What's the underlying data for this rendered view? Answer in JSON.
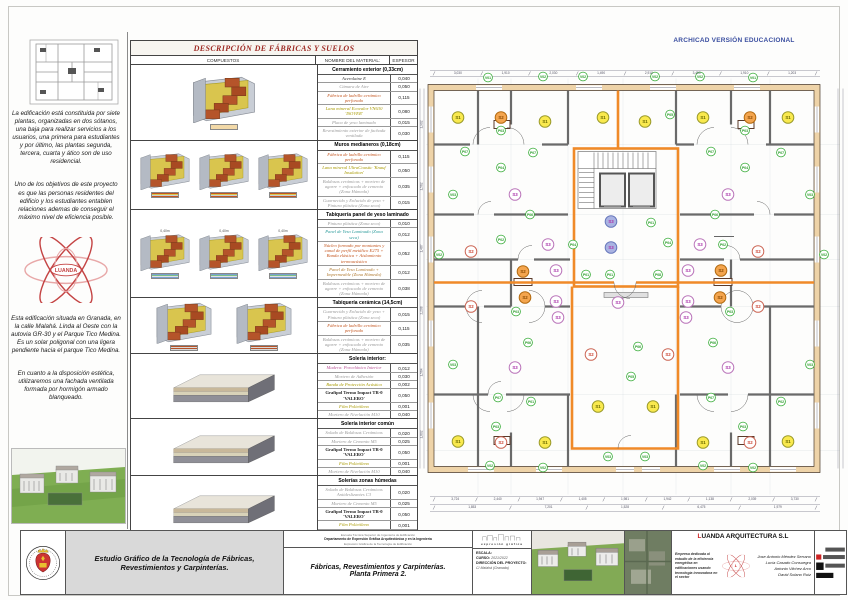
{
  "banner": {
    "archicad": "ARCHICAD VERSIÓN EDUCACIONAL"
  },
  "sidebar": {
    "paragraphs_top": [
      "La edificación está constituida por siete plantas, organizadas en dos sótanos, una baja para realizar servicios a los usuarios, una primera para estudiantes y por último, las plantas segunda, tercera, cuarta y ático son de uso residencial.",
      "Uno de los objetivos de este proyecto es que las personas residentes del edificio y los estudiantes entablen relaciones ademas de conseguir el máximo nivel de eficiencia posible."
    ],
    "paragraphs_bottom": [
      "Esta edificación situada en Granada, en la calle Malahá. Linda al Oeste con la autovia GR-30 y el Parque Tico Medina. Es un solar poligonal con una ligera pendiente hacia el parque Tico Medina.",
      "En cuanto a la disposición estética, utilizaremos una fachada ventilada formada por hormigón armado blanqueado."
    ],
    "luanda_logo_text": "LUANDA"
  },
  "table": {
    "title": "DESCRIPCIÓN DE FÁBRICAS Y SUELOS",
    "columns": {
      "compuestos": "COMPUESTOS",
      "nombre": "NOMBRE DEL MATERIAL:",
      "espesor": "ESPESOR"
    },
    "sections": [
      {
        "header": "Cerramiento exterior (0,33cm)",
        "images": 1,
        "img_type": "wall",
        "leg": "a",
        "rows": [
          {
            "name": "Acerolaine E",
            "v": "0,040",
            "c": "#333333"
          },
          {
            "name": "Cámara de Aire",
            "v": "0,050",
            "c": "#9a9a9a"
          },
          {
            "name": "Fábrica de ladrillo cerámico perforado",
            "v": "0,115",
            "c": "#c4551e"
          },
          {
            "name": "Lana mineral Ecovalor VN630 'ISOVER'",
            "v": "0,080",
            "c": "#a89a00"
          },
          {
            "name": "Placa de yeso laminado",
            "v": "0,015",
            "c": "#9a9a9a"
          },
          {
            "name": "Revestimiento exterior de fachada ventilada",
            "v": "0,030",
            "c": "#9a9a9a"
          }
        ]
      },
      {
        "header": "Muros medianeros (0,18cm)",
        "images": 3,
        "img_type": "wall",
        "leg": "b",
        "rows": [
          {
            "name": "Fábrica de ladrillo cerámico perforado",
            "v": "0,115",
            "c": "#c4551e"
          },
          {
            "name": "Lana mineral UltraCoustic 'Knauf Insulation'",
            "v": "0,050",
            "c": "#a89a00"
          },
          {
            "name": "Baldosas cerámicas + mortero de agarre + enfoscado de cemento (Zona Húmeda)",
            "v": "0,035",
            "c": "#9a9a9a"
          },
          {
            "name": "Guarnecido y Enlucido de yeso + Pintura plástica (Zona seca)",
            "v": "0,015",
            "c": "#9a9a9a"
          }
        ]
      },
      {
        "header": "Tabiquería panel de yeso laminado",
        "images": 3,
        "img_type": "wall",
        "leg": "c",
        "img_note": "0,40m",
        "rows": [
          {
            "name": "Pintura plástica (Zona seca)",
            "v": "0,010",
            "c": "#9a9a9a"
          },
          {
            "name": "Panel de Yeso Laminado (Zona seca)",
            "v": "0,012",
            "c": "#2a9a9a"
          },
          {
            "name": "Núcleo formado por montantes y canal de perfil metálico E275 + Banda elástica + Aislamiento termoacústico",
            "v": "0,052",
            "c": "#c4551e"
          },
          {
            "name": "Panel de Yeso Laminado + Impermeable (Zona Húmeda)",
            "v": "0,012",
            "c": "#b07a30"
          },
          {
            "name": "Baldosas cerámicas + mortero de agarre + enfoscado de cemento (Zona Húmeda)",
            "v": "0,038",
            "c": "#9a9a9a"
          }
        ]
      },
      {
        "header": "Tabiquería cerámica (14,5cm)",
        "images": 2,
        "img_type": "wall",
        "leg": "d",
        "rows": [
          {
            "name": "Guarnecido y Enlucido de yeso + Pintura plástica (Zona seca)",
            "v": "0,015",
            "c": "#9a9a9a"
          },
          {
            "name": "Fábrica de ladrillo cerámico perforado",
            "v": "0,115",
            "c": "#c4551e"
          },
          {
            "name": "Baldosas cerámicas + mortero de agarre + enfoscado de cemento (Zona Húmeda)",
            "v": "0,035",
            "c": "#9a9a9a"
          }
        ]
      },
      {
        "header": "Solería interior:",
        "images": 1,
        "img_type": "floor",
        "leg": "n",
        "rows": [
          {
            "name": "Madera: Porcelánico Interior",
            "v": "0,012",
            "c": "#bb5599"
          },
          {
            "name": "Mortero de Adhesión",
            "v": "0,030",
            "c": "#9a9a9a"
          },
          {
            "name": "Banda de Protección Acústica",
            "v": "0,002",
            "c": "#a89a00"
          },
          {
            "name": "Grafipol Termo Impact TR-0 'VALERO'",
            "v": "0,050",
            "c": "#222222",
            "b": true
          },
          {
            "name": "Film Polietileno",
            "v": "0,001",
            "c": "#a89a00"
          },
          {
            "name": "Mortero de Nivelación M10",
            "v": "0,040",
            "c": "#9a9a9a"
          }
        ]
      },
      {
        "header": "Solería interior común",
        "images": 1,
        "img_type": "floor",
        "leg": "n",
        "rows": [
          {
            "name": "Solado de Baldosas Cerámicas",
            "v": "0,020",
            "c": "#9a9a9a"
          },
          {
            "name": "Mortero de Cemento M5",
            "v": "0,025",
            "c": "#9a9a9a"
          },
          {
            "name": "Grafipol Termo Impact TR-0 'VALERO'",
            "v": "0,050",
            "c": "#222222",
            "b": true
          },
          {
            "name": "Film Polietileno",
            "v": "0,001",
            "c": "#a89a00"
          },
          {
            "name": "Mortero de Nivelación M10",
            "v": "0,040",
            "c": "#9a9a9a"
          }
        ]
      },
      {
        "header": "Solerías zonas húmedas",
        "images": 1,
        "img_type": "floor",
        "leg": "n",
        "rows": [
          {
            "name": "Solado de Baldosas Cerámicas Antideslizantes C3",
            "v": "0,020",
            "c": "#9a9a9a"
          },
          {
            "name": "Mortero de Cemento M5",
            "v": "0,025",
            "c": "#9a9a9a"
          },
          {
            "name": "Grafipol Termo Impact TR-0 'VALERO'",
            "v": "0,050",
            "c": "#222222",
            "b": true
          },
          {
            "name": "Film Polietileno",
            "v": "0,001",
            "c": "#a89a00"
          },
          {
            "name": "Mortero de Nivelación M10",
            "v": "0,040",
            "c": "#9a9a9a"
          }
        ]
      }
    ]
  },
  "plan": {
    "colors": {
      "s1": {
        "fill": "#f9e94e",
        "stroke": "#9a9a2a",
        "text": "#6a6a00"
      },
      "s2o": {
        "fill": "#f4a54e",
        "stroke": "#b26a10",
        "text": "#8a4a00"
      },
      "s2w": {
        "fill": "#ffffff",
        "stroke": "#cc6655",
        "text": "#cc4433"
      },
      "s3w": {
        "fill": "#ffffff",
        "stroke": "#bb77bb",
        "text": "#aa33aa"
      },
      "s3b": {
        "fill": "#aab3e2",
        "stroke": "#6677bb",
        "text": "#aa33aa"
      },
      "v": {
        "fill": "#ffffff",
        "stroke": "#33aa33",
        "text": "#229922"
      },
      "p": {
        "fill": "#ffffff",
        "stroke": "#33aa33",
        "text": "#229922"
      }
    },
    "labels": [
      {
        "t": "S1",
        "k": "s1",
        "x": 40,
        "y": 63
      },
      {
        "t": "S2",
        "k": "s2o",
        "x": 83,
        "y": 63
      },
      {
        "t": "S1",
        "k": "s1",
        "x": 127,
        "y": 67
      },
      {
        "t": "S1",
        "k": "s1",
        "x": 185,
        "y": 63
      },
      {
        "t": "S1",
        "k": "s1",
        "x": 227,
        "y": 67
      },
      {
        "t": "S1",
        "k": "s1",
        "x": 285,
        "y": 63
      },
      {
        "t": "S2",
        "k": "s2o",
        "x": 332,
        "y": 63
      },
      {
        "t": "S1",
        "k": "s1",
        "x": 370,
        "y": 63
      },
      {
        "t": "S3",
        "k": "s3w",
        "x": 97,
        "y": 140
      },
      {
        "t": "S3",
        "k": "s3w",
        "x": 310,
        "y": 140
      },
      {
        "t": "S3",
        "k": "s3b",
        "x": 193,
        "y": 167
      },
      {
        "t": "S3",
        "k": "s3b",
        "x": 193,
        "y": 193
      },
      {
        "t": "S2",
        "k": "s2w",
        "x": 53,
        "y": 197
      },
      {
        "t": "S2",
        "k": "s2w",
        "x": 340,
        "y": 197
      },
      {
        "t": "S3",
        "k": "s3w",
        "x": 130,
        "y": 190
      },
      {
        "t": "S3",
        "k": "s3w",
        "x": 282,
        "y": 190
      },
      {
        "t": "S2",
        "k": "s2o",
        "x": 105,
        "y": 217
      },
      {
        "t": "S3",
        "k": "s3w",
        "x": 138,
        "y": 216
      },
      {
        "t": "S3",
        "k": "s3w",
        "x": 270,
        "y": 216
      },
      {
        "t": "S2",
        "k": "s2o",
        "x": 303,
        "y": 216
      },
      {
        "t": "S2",
        "k": "s2w",
        "x": 53,
        "y": 252
      },
      {
        "t": "S2",
        "k": "s2o",
        "x": 107,
        "y": 243
      },
      {
        "t": "S3",
        "k": "s3w",
        "x": 138,
        "y": 247
      },
      {
        "t": "S3",
        "k": "s3w",
        "x": 200,
        "y": 248
      },
      {
        "t": "S3",
        "k": "s3w",
        "x": 270,
        "y": 247
      },
      {
        "t": "S2",
        "k": "s2o",
        "x": 302,
        "y": 243
      },
      {
        "t": "S2",
        "k": "s2w",
        "x": 340,
        "y": 252
      },
      {
        "t": "S3",
        "k": "s3w",
        "x": 140,
        "y": 263
      },
      {
        "t": "S3",
        "k": "s3w",
        "x": 268,
        "y": 263
      },
      {
        "t": "S2",
        "k": "s2w",
        "x": 173,
        "y": 300
      },
      {
        "t": "S2",
        "k": "s2w",
        "x": 250,
        "y": 300
      },
      {
        "t": "S3",
        "k": "s3w",
        "x": 97,
        "y": 313
      },
      {
        "t": "S3",
        "k": "s3w",
        "x": 310,
        "y": 313
      },
      {
        "t": "S1",
        "k": "s1",
        "x": 180,
        "y": 352
      },
      {
        "t": "S1",
        "k": "s1",
        "x": 235,
        "y": 352
      },
      {
        "t": "S1",
        "k": "s1",
        "x": 40,
        "y": 387
      },
      {
        "t": "S2",
        "k": "s2w",
        "x": 83,
        "y": 388
      },
      {
        "t": "S1",
        "k": "s1",
        "x": 127,
        "y": 388
      },
      {
        "t": "S1",
        "k": "s1",
        "x": 285,
        "y": 388
      },
      {
        "t": "S2",
        "k": "s2w",
        "x": 332,
        "y": 388
      },
      {
        "t": "S1",
        "k": "s1",
        "x": 370,
        "y": 387
      },
      {
        "t": "V01",
        "k": "v",
        "x": 70,
        "y": 23
      },
      {
        "t": "V02",
        "k": "v",
        "x": 125,
        "y": 22
      },
      {
        "t": "V02",
        "k": "v",
        "x": 165,
        "y": 22
      },
      {
        "t": "V02",
        "k": "v",
        "x": 237,
        "y": 22
      },
      {
        "t": "V02",
        "k": "v",
        "x": 282,
        "y": 22
      },
      {
        "t": "V01",
        "k": "v",
        "x": 335,
        "y": 23
      },
      {
        "t": "V03",
        "k": "v",
        "x": 35,
        "y": 140
      },
      {
        "t": "V02",
        "k": "v",
        "x": 21,
        "y": 200
      },
      {
        "t": "V03",
        "k": "v",
        "x": 35,
        "y": 310
      },
      {
        "t": "V03",
        "k": "v",
        "x": 392,
        "y": 140
      },
      {
        "t": "V02",
        "k": "v",
        "x": 406,
        "y": 200
      },
      {
        "t": "V03",
        "k": "v",
        "x": 392,
        "y": 310
      },
      {
        "t": "V03",
        "k": "v",
        "x": 190,
        "y": 402
      },
      {
        "t": "V03",
        "k": "v",
        "x": 227,
        "y": 402
      },
      {
        "t": "V02",
        "k": "v",
        "x": 72,
        "y": 411
      },
      {
        "t": "V02",
        "k": "v",
        "x": 125,
        "y": 413
      },
      {
        "t": "V02",
        "k": "v",
        "x": 285,
        "y": 411
      },
      {
        "t": "V02",
        "k": "v",
        "x": 335,
        "y": 413
      },
      {
        "t": "P03",
        "k": "p",
        "x": 83,
        "y": 76
      },
      {
        "t": "P03",
        "k": "p",
        "x": 327,
        "y": 76
      },
      {
        "t": "P05",
        "k": "p",
        "x": 252,
        "y": 60
      },
      {
        "t": "P07",
        "k": "p",
        "x": 47,
        "y": 97
      },
      {
        "t": "P07",
        "k": "p",
        "x": 115,
        "y": 98
      },
      {
        "t": "P07",
        "k": "p",
        "x": 293,
        "y": 97
      },
      {
        "t": "P07",
        "k": "p",
        "x": 363,
        "y": 98
      },
      {
        "t": "P04",
        "k": "p",
        "x": 83,
        "y": 113
      },
      {
        "t": "P04",
        "k": "p",
        "x": 327,
        "y": 113
      },
      {
        "t": "P06",
        "k": "p",
        "x": 112,
        "y": 160
      },
      {
        "t": "P06",
        "k": "p",
        "x": 297,
        "y": 160
      },
      {
        "t": "P01",
        "k": "p",
        "x": 233,
        "y": 168
      },
      {
        "t": "P02",
        "k": "p",
        "x": 83,
        "y": 185
      },
      {
        "t": "P04",
        "k": "p",
        "x": 155,
        "y": 190
      },
      {
        "t": "P04",
        "k": "p",
        "x": 250,
        "y": 188
      },
      {
        "t": "P02",
        "k": "p",
        "x": 305,
        "y": 190
      },
      {
        "t": "P01",
        "k": "p",
        "x": 168,
        "y": 220
      },
      {
        "t": "P01",
        "k": "p",
        "x": 192,
        "y": 220
      },
      {
        "t": "P08",
        "k": "p",
        "x": 240,
        "y": 220
      },
      {
        "t": "P03",
        "k": "p",
        "x": 98,
        "y": 257
      },
      {
        "t": "P03",
        "k": "p",
        "x": 312,
        "y": 257
      },
      {
        "t": "P06",
        "k": "p",
        "x": 110,
        "y": 288
      },
      {
        "t": "P06",
        "k": "p",
        "x": 220,
        "y": 292
      },
      {
        "t": "P06",
        "k": "p",
        "x": 295,
        "y": 288
      },
      {
        "t": "P07",
        "k": "p",
        "x": 80,
        "y": 343
      },
      {
        "t": "P01",
        "k": "p",
        "x": 113,
        "y": 347
      },
      {
        "t": "P05",
        "k": "p",
        "x": 213,
        "y": 322
      },
      {
        "t": "P07",
        "k": "p",
        "x": 293,
        "y": 343
      },
      {
        "t": "P02",
        "k": "p",
        "x": 363,
        "y": 347
      },
      {
        "t": "P03",
        "k": "p",
        "x": 78,
        "y": 372
      },
      {
        "t": "P03",
        "k": "p",
        "x": 325,
        "y": 372
      },
      {
        "t": "P04",
        "k": "p",
        "x": 640,
        "y": 0
      }
    ],
    "dims_top": [
      "3,030",
      "1,910",
      "2,030",
      "1,490",
      "2,910",
      "3,450",
      "1,910",
      "1,203"
    ],
    "dims_bottom1": [
      "3,724",
      "2,440",
      "1,947",
      "1,405",
      "1,981",
      "1,942",
      "1,138",
      "2,039",
      "3,730"
    ],
    "dims_bottom2": [
      "1,853",
      "7,201",
      "1,528",
      "6,475",
      "1,979"
    ],
    "dims_left": [
      "1,902",
      "1,562",
      "1,487",
      "2,208",
      "1,564",
      "1,802"
    ]
  },
  "titleblock": {
    "left_title": "Estudio Gráfico de la Tecnología de Fábricas, Revestimientos y Carpinterías.",
    "dept_line1": "Escuela Técnica Superior de Ingeniería de Edificación",
    "dept_line2": "Departamento de Expresión Gráfica Arquitectónica y en la Ingeniería",
    "dept_line3": "Expresión Gráfica de la Tecnología de Edificación",
    "sheet_title": "Fábricas, Revestimientos y Carpinterías.",
    "sheet_subtitle": "Planta Primera 2.",
    "logo_text": "expresión gráfica",
    "escala_label": "ESCALA:",
    "curso_label": "CURSO:",
    "curso_value": "2021/2022",
    "direccion_label": "DIRECCIÓN DEL PROYECTO:",
    "direccion_value": "C/ Malahá (Granada)",
    "company": {
      "first": "L",
      "rest": "UANDA ARQUITECTURA S.L"
    },
    "company_desc": "Empresa dedicada al estudio de la eficiencia energética en edificaciones usando tecnología innovadora en el sector",
    "names": [
      "Jose Antonio Méndez Serrano",
      "Lucía Casado Consuegra",
      "Antonio Vilchez Arco",
      "David Solano Ruiz"
    ]
  }
}
